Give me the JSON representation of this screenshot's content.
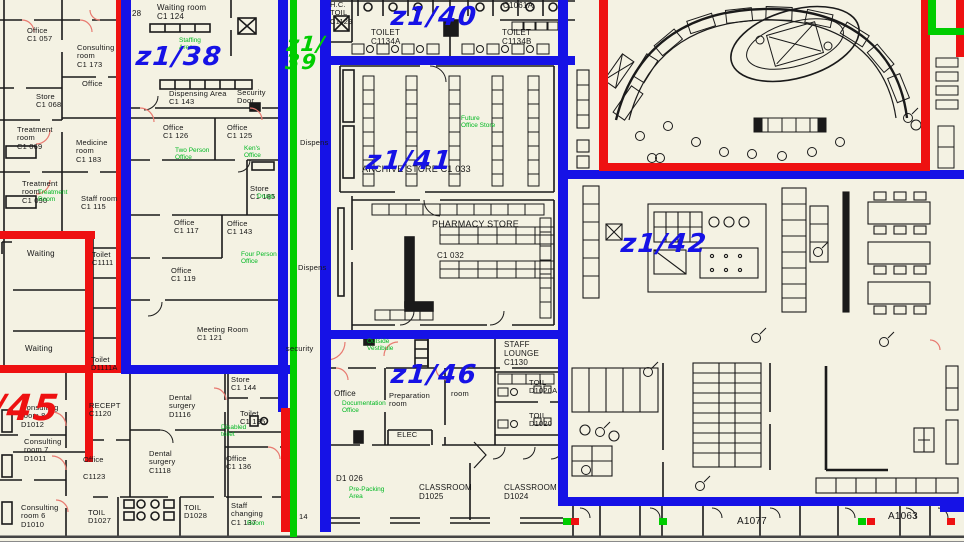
{
  "colors": {
    "zone_blue": "#1612e6",
    "zone_red": "#ee1111",
    "zone_green": "#00cd00",
    "annotation_green": "#00b822",
    "wall_black": "#1a1a1a",
    "door_red": "#e87a70",
    "background": "#f4f2e3"
  },
  "zones": [
    {
      "label": "z1/38",
      "color": "blue",
      "x": 136,
      "y": 46,
      "size": 26
    },
    {
      "label": "z1/\n39",
      "color": "green",
      "x": 286,
      "y": 36,
      "size": 21
    },
    {
      "label": "z1/40",
      "color": "blue",
      "x": 391,
      "y": 6,
      "size": 26
    },
    {
      "label": "z1/41",
      "color": "blue",
      "x": 366,
      "y": 150,
      "size": 26
    },
    {
      "label": "z1/42",
      "color": "blue",
      "x": 621,
      "y": 233,
      "size": 26
    },
    {
      "label": "/45",
      "color": "red",
      "x": -8,
      "y": 394,
      "size": 36
    },
    {
      "label": "z1/46",
      "color": "blue",
      "x": 391,
      "y": 364,
      "size": 26
    }
  ],
  "rooms": [
    {
      "lines": [
        "Office",
        "C1  057"
      ],
      "x": 27,
      "y": 27
    },
    {
      "lines": [
        "Consulting",
        "room",
        "C1  173"
      ],
      "x": 77,
      "y": 44
    },
    {
      "lines": [
        "Office"
      ],
      "x": 82,
      "y": 80
    },
    {
      "lines": [
        "Store",
        "C1  068"
      ],
      "x": 36,
      "y": 93
    },
    {
      "lines": [
        "Treatment",
        "room",
        "C1  069"
      ],
      "x": 17,
      "y": 126
    },
    {
      "lines": [
        "Medicine",
        "room",
        "C1  183"
      ],
      "x": 76,
      "y": 139
    },
    {
      "lines": [
        "Treatment",
        "room",
        "C1  090"
      ],
      "x": 22,
      "y": 180
    },
    {
      "lines": [
        "Staff room",
        "C1  115"
      ],
      "x": 81,
      "y": 195
    },
    {
      "lines": [
        "Waiting"
      ],
      "x": 27,
      "y": 250,
      "size": 8
    },
    {
      "lines": [
        "Toilet",
        "C1111"
      ],
      "x": 92,
      "y": 251
    },
    {
      "lines": [
        "Waiting"
      ],
      "x": 25,
      "y": 345,
      "size": 8
    },
    {
      "lines": [
        "Toilet",
        "D1111A"
      ],
      "x": 91,
      "y": 356
    },
    {
      "lines": [
        "Waiting  room",
        "C1  124"
      ],
      "x": 157,
      "y": 4,
      "size": 8
    },
    {
      "lines": [
        "Dispensing  Area",
        "C1  143"
      ],
      "x": 169,
      "y": 90
    },
    {
      "lines": [
        "Security",
        "Door"
      ],
      "x": 237,
      "y": 89
    },
    {
      "lines": [
        "Office",
        "C1  126"
      ],
      "x": 163,
      "y": 124
    },
    {
      "lines": [
        "Office",
        "C1  125"
      ],
      "x": 227,
      "y": 124
    },
    {
      "lines": [
        "Store",
        "C1  185"
      ],
      "x": 250,
      "y": 185
    },
    {
      "lines": [
        "Office",
        "C1  117"
      ],
      "x": 174,
      "y": 219
    },
    {
      "lines": [
        "Office",
        "C1  143"
      ],
      "x": 227,
      "y": 220
    },
    {
      "lines": [
        "Office",
        "C1  119"
      ],
      "x": 171,
      "y": 267
    },
    {
      "lines": [
        "Meeting  Room",
        "C1  121"
      ],
      "x": 197,
      "y": 326
    },
    {
      "lines": [
        "H.C.",
        "TOIL",
        "C1129"
      ],
      "x": 330,
      "y": 1
    },
    {
      "lines": [
        "TOILET",
        "C1134A"
      ],
      "x": 371,
      "y": 29,
      "size": 8
    },
    {
      "lines": [
        "TOILET",
        "C1134B"
      ],
      "x": 502,
      "y": 29,
      "size": 8
    },
    {
      "lines": [
        "C1061A"
      ],
      "x": 503,
      "y": 2,
      "size": 8
    },
    {
      "lines": [
        "ARCHIVE  STORE    C1  033"
      ],
      "x": 362,
      "y": 164,
      "size": 9
    },
    {
      "lines": [
        "PHARMACY  STORE"
      ],
      "x": 432,
      "y": 219,
      "size": 9
    },
    {
      "lines": [
        "C1  032"
      ],
      "x": 437,
      "y": 252,
      "size": 8
    },
    {
      "lines": [
        "STAFF",
        "LOUNGE",
        "C1130"
      ],
      "x": 504,
      "y": 341,
      "size": 8
    },
    {
      "lines": [
        "TOIL",
        "D1020A"
      ],
      "x": 529,
      "y": 379
    },
    {
      "lines": [
        "TOIL",
        "D1020"
      ],
      "x": 529,
      "y": 412
    },
    {
      "lines": [
        "Office"
      ],
      "x": 334,
      "y": 390,
      "size": 8
    },
    {
      "lines": [
        "Preparation",
        "room"
      ],
      "x": 389,
      "y": 392
    },
    {
      "lines": [
        "room"
      ],
      "x": 451,
      "y": 390
    },
    {
      "lines": [
        "ELEC"
      ],
      "x": 397,
      "y": 431
    },
    {
      "lines": [
        "D1  026"
      ],
      "x": 336,
      "y": 475,
      "size": 8
    },
    {
      "lines": [
        "CLASSROOM",
        "D1025"
      ],
      "x": 419,
      "y": 484,
      "size": 8
    },
    {
      "lines": [
        "CLASSROOM",
        "D1024"
      ],
      "x": 504,
      "y": 484,
      "size": 8
    },
    {
      "lines": [
        "RECEPT",
        "C1120"
      ],
      "x": 89,
      "y": 402
    },
    {
      "lines": [
        "Dental",
        "surgery",
        "D1116"
      ],
      "x": 169,
      "y": 394
    },
    {
      "lines": [
        "Store",
        "C1  144"
      ],
      "x": 231,
      "y": 376
    },
    {
      "lines": [
        "Toilet",
        "C1  135"
      ],
      "x": 240,
      "y": 410
    },
    {
      "lines": [
        "Office",
        "",
        "C1123"
      ],
      "x": 83,
      "y": 456
    },
    {
      "lines": [
        "Dental",
        "surgery",
        "C1118"
      ],
      "x": 149,
      "y": 450
    },
    {
      "lines": [
        "Office",
        "C1  136"
      ],
      "x": 226,
      "y": 455
    },
    {
      "lines": [
        "Consulting",
        "room  8",
        "D1012"
      ],
      "x": 21,
      "y": 404
    },
    {
      "lines": [
        "Consulting",
        "room  7",
        "D1011"
      ],
      "x": 24,
      "y": 438
    },
    {
      "lines": [
        "Consulting",
        "room  6",
        "D1010"
      ],
      "x": 21,
      "y": 504
    },
    {
      "lines": [
        "TOIL",
        "D1027"
      ],
      "x": 88,
      "y": 509
    },
    {
      "lines": [
        "TOIL",
        "D1028"
      ],
      "x": 184,
      "y": 504
    },
    {
      "lines": [
        "Staff",
        "changing",
        "C1  137"
      ],
      "x": 231,
      "y": 502
    },
    {
      "lines": [
        "Dispens"
      ],
      "x": 300,
      "y": 139
    },
    {
      "lines": [
        "Dispens"
      ],
      "x": 298,
      "y": 264
    },
    {
      "lines": [
        "security"
      ],
      "x": 286,
      "y": 345
    },
    {
      "lines": [
        "28"
      ],
      "x": 132,
      "y": 10,
      "size": 8
    },
    {
      "lines": [
        "14"
      ],
      "x": 299,
      "y": 513
    },
    {
      "lines": [
        "A1077"
      ],
      "x": 737,
      "y": 516,
      "size": 10
    },
    {
      "lines": [
        "A1063"
      ],
      "x": 888,
      "y": 511,
      "size": 10
    }
  ],
  "annotations": [
    {
      "lines": [
        "Staffing",
        "Area"
      ],
      "x": 179,
      "y": 37
    },
    {
      "lines": [
        "Treatment",
        "Room"
      ],
      "x": 38,
      "y": 189
    },
    {
      "lines": [
        "Two  Person",
        "Office"
      ],
      "x": 175,
      "y": 147
    },
    {
      "lines": [
        "Ken's",
        "Office"
      ],
      "x": 244,
      "y": 145
    },
    {
      "lines": [
        "Drugs"
      ],
      "x": 257,
      "y": 193
    },
    {
      "lines": [
        "Four  Person",
        "Office"
      ],
      "x": 241,
      "y": 251
    },
    {
      "lines": [
        "Future",
        "Office  Store"
      ],
      "x": 461,
      "y": 115
    },
    {
      "lines": [
        "Outside",
        "Vestibule"
      ],
      "x": 367,
      "y": 338
    },
    {
      "lines": [
        "Documentation",
        "Office"
      ],
      "x": 342,
      "y": 400
    },
    {
      "lines": [
        "Pre-Packing",
        "Area"
      ],
      "x": 349,
      "y": 486
    },
    {
      "lines": [
        "Disabled",
        "toilet"
      ],
      "x": 221,
      "y": 424
    },
    {
      "lines": [
        "Room"
      ],
      "x": 247,
      "y": 520
    }
  ],
  "markers": [
    {
      "x": 563,
      "color": "green"
    },
    {
      "x": 571,
      "color": "red"
    },
    {
      "x": 659,
      "color": "green"
    },
    {
      "x": 858,
      "color": "green"
    },
    {
      "x": 867,
      "color": "red"
    },
    {
      "x": 947,
      "color": "red"
    }
  ]
}
